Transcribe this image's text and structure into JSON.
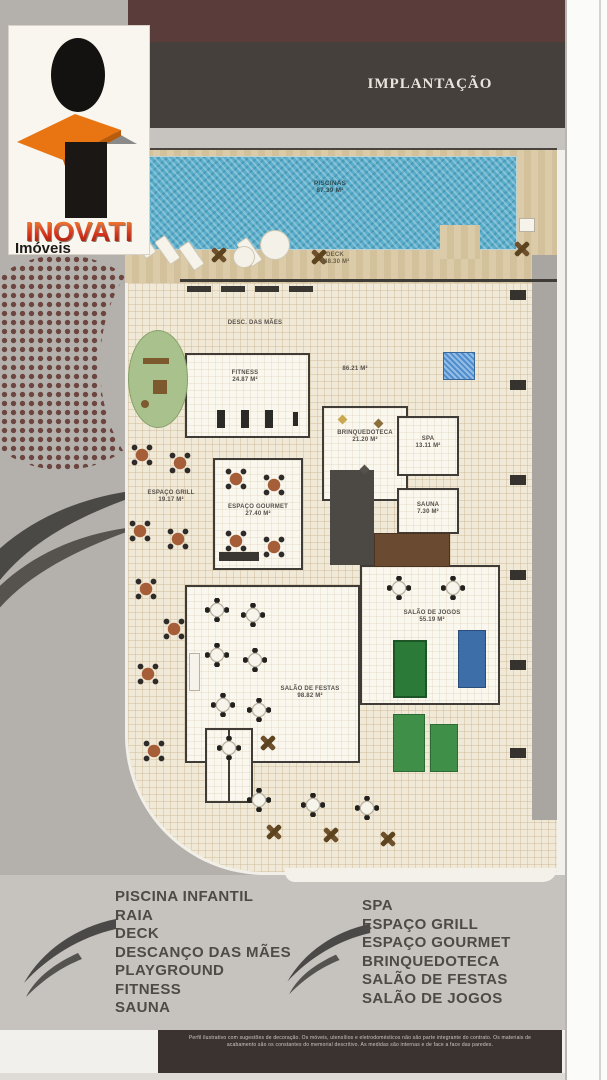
{
  "header": {
    "title": "IMPLANTAÇÃO"
  },
  "logo": {
    "name": "INOVATI",
    "subtitle": "Imóveis"
  },
  "plan": {
    "rooms": [
      {
        "label": "PISCINAS",
        "area": "87.39 M²"
      },
      {
        "label": "DECK",
        "area": "138.30 M²"
      },
      {
        "label": "DESC. DAS MÃES",
        "area": ""
      },
      {
        "label": "FITNESS",
        "area": "24.87 M²"
      },
      {
        "label": "",
        "area": "86.21 M²"
      },
      {
        "label": "ESPAÇO GRILL",
        "area": "19.17 M²"
      },
      {
        "label": "ESPAÇO GOURMET",
        "area": "27.40 M²"
      },
      {
        "label": "BRINQUEDOTECA",
        "area": "21.20 M²"
      },
      {
        "label": "SPA",
        "area": "13.11 M²"
      },
      {
        "label": "SAUNA",
        "area": "7.30 M²"
      },
      {
        "label": "SALÃO DE JOGOS",
        "area": "55.19 M²"
      },
      {
        "label": "SALÃO DE FESTAS",
        "area": "98.82 M²"
      }
    ]
  },
  "legend_left": {
    "items": [
      "PISCINA INFANTIL",
      "RAIA",
      "DECK",
      "DESCANÇO DAS MÃES",
      "PLAYGROUND",
      "FITNESS",
      "SAUNA"
    ]
  },
  "legend_right": {
    "items": [
      "SPA",
      "ESPAÇO GRILL",
      "ESPAÇO GOURMET",
      "BRINQUEDOTECA",
      "SALÃO DE FESTAS",
      "SALÃO DE JOGOS"
    ]
  },
  "footer": {
    "line1": "Perfil ilustrativo com sugestões de decoração. Os móveis, utensílios e eletrodomésticos não são parte integrante do contrato. Os materiais de",
    "line2": "acabamento são os constantes do memorial descritivo. As medidas são internas e de face a face das paredes."
  },
  "colors": {
    "accent_orange": "#e87511",
    "maroon_band": "#5a3c3a",
    "charcoal_band": "#46403c",
    "pool_blue": "#59aecb",
    "deck_beige": "#dbcba8"
  }
}
